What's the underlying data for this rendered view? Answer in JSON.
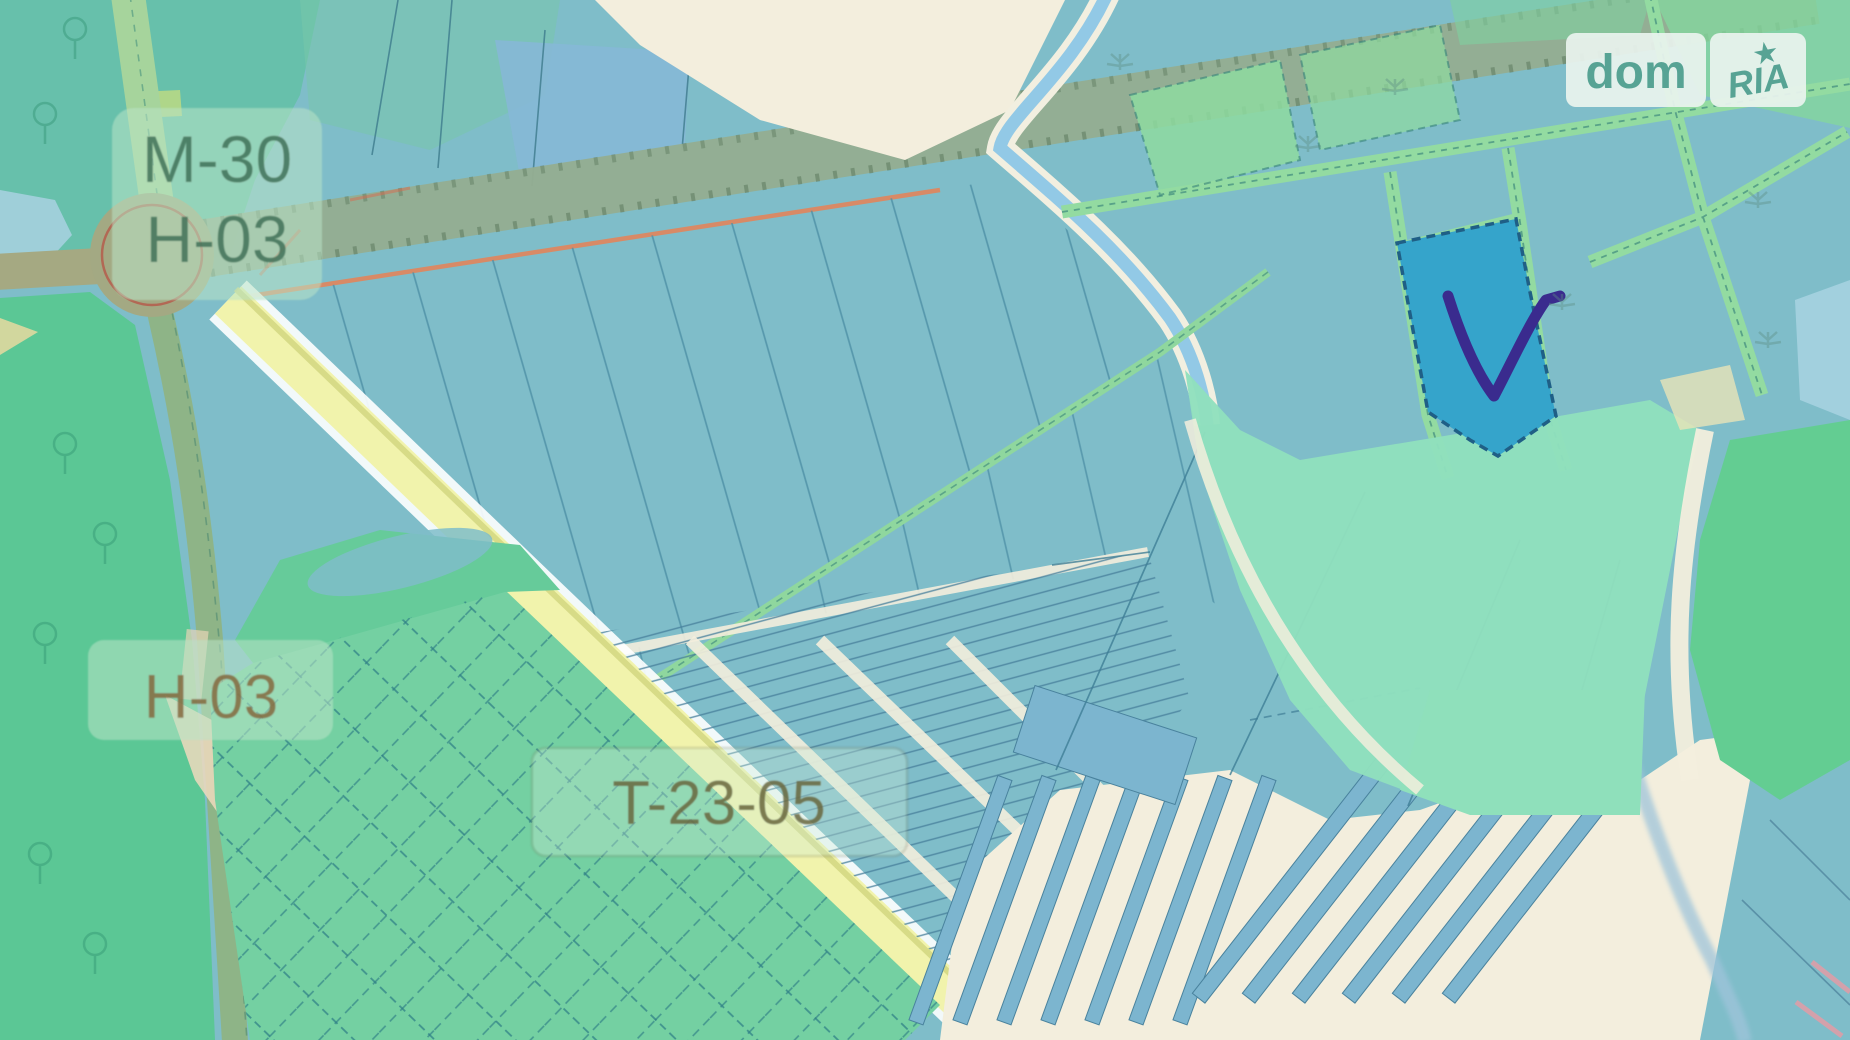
{
  "labels": {
    "highway_badge": {
      "line1": "M-30",
      "line2": "H-03"
    },
    "h_road_badge": {
      "text": "H-03"
    },
    "t_road_badge": {
      "text": "T-23-05"
    }
  },
  "watermark": {
    "left": "dom",
    "right": "RIA",
    "star": "★"
  },
  "marker": {
    "type": "checkmark-on-selected-parcel"
  },
  "colors": {
    "base_teal": "#7fbdc9",
    "dark_teal_wood": "#67c0ab",
    "forest_green": "#5bc795",
    "grid_parcel_green": "#74d0a2",
    "lane_green": "#93dba1",
    "highway_olive": "#94ae92",
    "road_yellow": "#f1f3ac",
    "sand_cream": "#f3eedd",
    "selected_parcel_blue": "#35a4cb",
    "marker_purple": "#3a2b8e",
    "stream_blue": "#8cc6e6",
    "valley_mint": "#90e0bd",
    "meadow_green": "#63cd92",
    "logo_teal": "#57a394",
    "roundabout_ring_red": "#b4604f"
  }
}
